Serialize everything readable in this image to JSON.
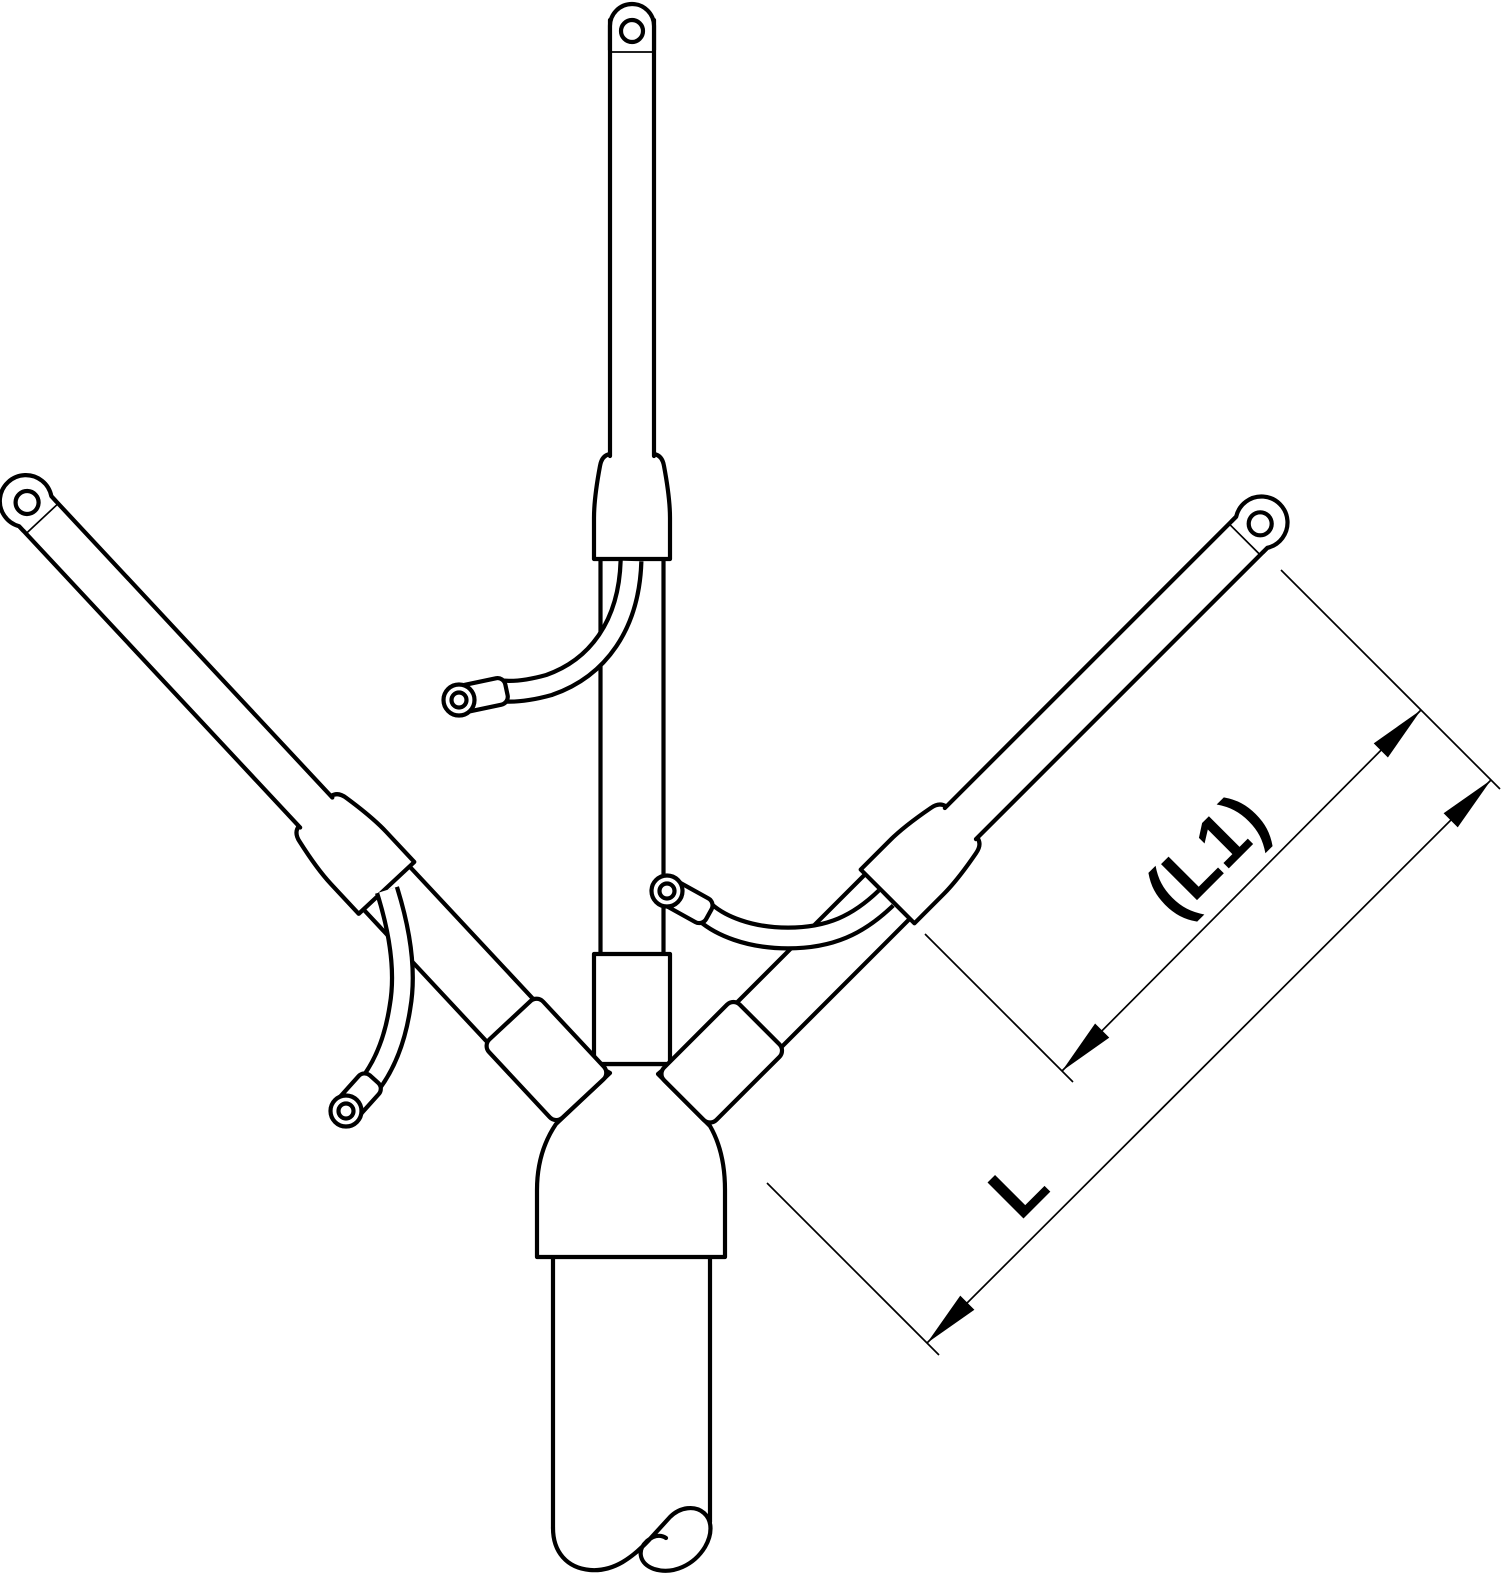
{
  "drawing": {
    "kind": "technical-line-drawing",
    "subject": "three-core cable termination with cable lugs, earth wires and dimension lines"
  },
  "labels": {
    "dimension_partial_length": "(L1)",
    "dimension_total_length": "L"
  },
  "colors": {
    "line": "#000000",
    "background": "#ffffff"
  }
}
